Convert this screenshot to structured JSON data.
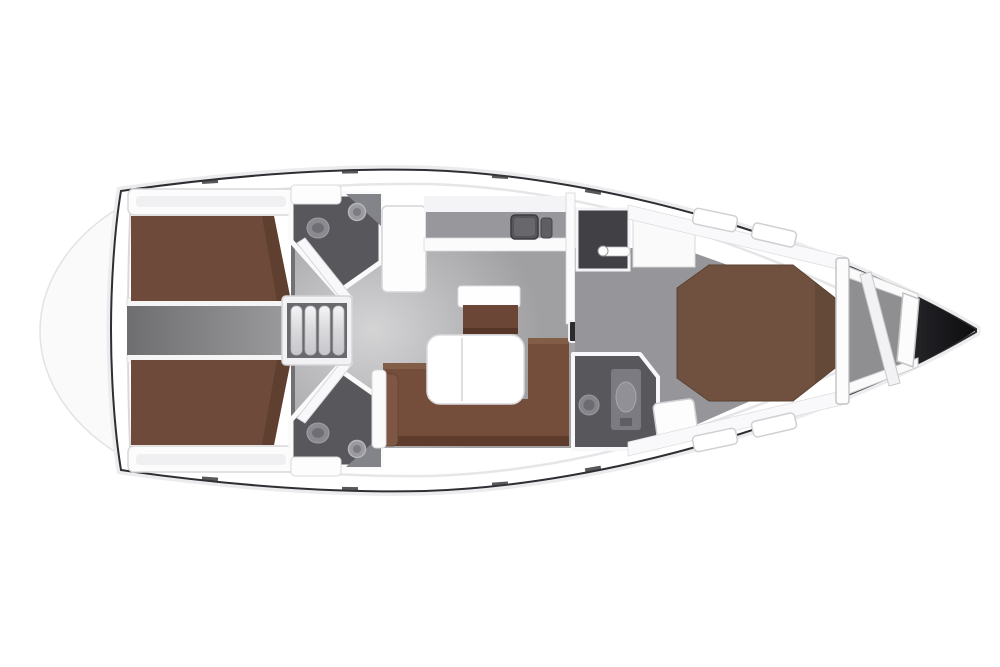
{
  "diagram": {
    "type": "yacht-interior-floor-plan",
    "orientation": {
      "bow": "right",
      "stern": "left"
    },
    "areas": [
      "swim-platform",
      "aft-cabin-port",
      "aft-cabin-starboard",
      "aft-head-port",
      "aft-head-starboard",
      "companionway-stairs",
      "galley",
      "salon",
      "salon-bench",
      "salon-sofa",
      "salon-table",
      "forward-wardrobe",
      "forward-head",
      "forward-cabin-v-berth",
      "anchor-locker",
      "bow"
    ]
  },
  "colors": {
    "background": "#ffffff",
    "hull_fill": "#ffffff",
    "hull_outline": "#2f2f33",
    "swim_platform": "#fafafa",
    "bed_brown": "#6d4a39",
    "vberth_brown": "#70513f",
    "sofa_brown": "#744e3b",
    "bench_brown": "#6b4636",
    "table_white": "#ffffff",
    "salon_floor": "#a0a0a3",
    "forward_floor": "#96969a",
    "floor_dark": "#717174",
    "head_room": "#58585c",
    "dark_locker": "#404045",
    "anchor_locker": "#8f8f92",
    "tv_dark": "#2c2c30"
  }
}
